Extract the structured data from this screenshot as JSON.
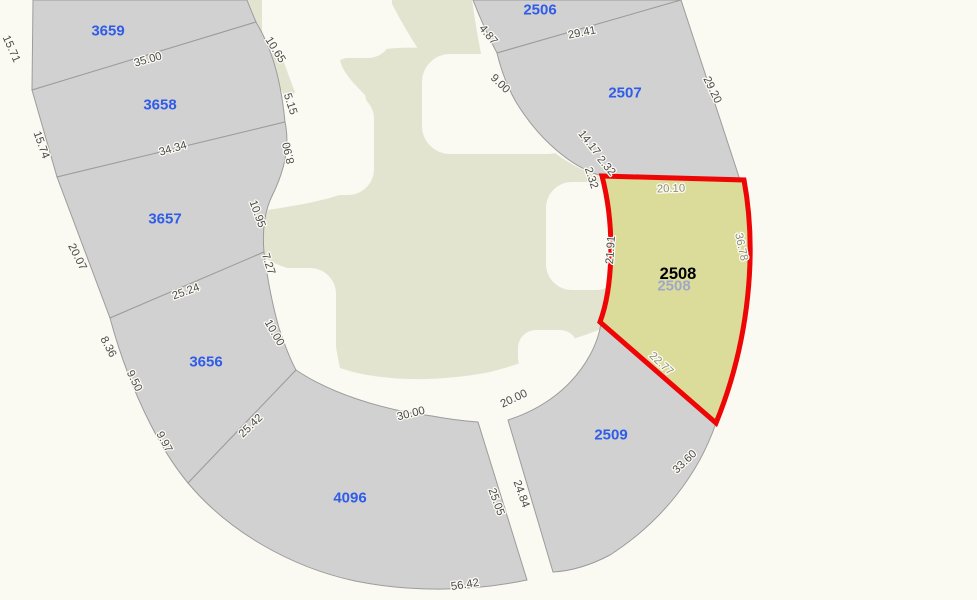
{
  "map": {
    "type": "cadastral-parcel-map",
    "colors": {
      "background": "#FAF9F2",
      "parcel_fill": "#D1D1D1",
      "parcel_line": "#9C9C9C",
      "green_area": "#E3E4D0",
      "highlight_fill": "#DCDC9A",
      "highlight_stroke": "#EE0505",
      "parcel_label_color": "#2F5CE8",
      "dim_label_color": "#4A4A4A",
      "dim_label_olive": "#8E8E74",
      "highlight_label_color": "#000000",
      "ghost_label_color": "#9FA8C8",
      "label_halo": "#FBFAF3"
    },
    "highlighted_parcel": {
      "id": "2508",
      "label": {
        "text": "2508",
        "x": 678,
        "y": 274
      },
      "ghost_label": {
        "text": "2508",
        "x": 674,
        "y": 286
      }
    },
    "parcel_labels": [
      {
        "id": "3659",
        "x": 108,
        "y": 31
      },
      {
        "id": "3658",
        "x": 160,
        "y": 105
      },
      {
        "id": "3657",
        "x": 165,
        "y": 219
      },
      {
        "id": "3656",
        "x": 206,
        "y": 362
      },
      {
        "id": "4096",
        "x": 350,
        "y": 498
      },
      {
        "id": "2506",
        "x": 540,
        "y": 10
      },
      {
        "id": "2507",
        "x": 625,
        "y": 93
      },
      {
        "id": "2509",
        "x": 611,
        "y": 435
      }
    ],
    "dimension_labels": [
      {
        "text": "15.71",
        "x": 11,
        "y": 49,
        "rot": 66
      },
      {
        "text": "35.00",
        "x": 148,
        "y": 60,
        "rot": -16
      },
      {
        "text": "15.74",
        "x": 41,
        "y": 145,
        "rot": 70
      },
      {
        "text": "34.34",
        "x": 173,
        "y": 149,
        "rot": -16
      },
      {
        "text": "20.07",
        "x": 77,
        "y": 257,
        "rot": 63
      },
      {
        "text": "25.24",
        "x": 186,
        "y": 292,
        "rot": -20
      },
      {
        "text": "8.36",
        "x": 108,
        "y": 347,
        "rot": 62
      },
      {
        "text": "9.50",
        "x": 134,
        "y": 381,
        "rot": 64
      },
      {
        "text": "9.97",
        "x": 164,
        "y": 442,
        "rot": 62
      },
      {
        "text": "25.42",
        "x": 251,
        "y": 426,
        "rot": -44
      },
      {
        "text": "10.65",
        "x": 275,
        "y": 50,
        "rot": 58
      },
      {
        "text": "5.15",
        "x": 290,
        "y": 104,
        "rot": 72
      },
      {
        "text": "8.90",
        "x": 289,
        "y": 153,
        "rot": -103
      },
      {
        "text": "10.95",
        "x": 257,
        "y": 214,
        "rot": 70
      },
      {
        "text": "7.27",
        "x": 268,
        "y": 264,
        "rot": 72
      },
      {
        "text": "10.00",
        "x": 274,
        "y": 333,
        "rot": 60
      },
      {
        "text": "30.00",
        "x": 411,
        "y": 414,
        "rot": -14
      },
      {
        "text": "20.00",
        "x": 514,
        "y": 399,
        "rot": -25
      },
      {
        "text": "25.05",
        "x": 496,
        "y": 502,
        "rot": 70
      },
      {
        "text": "24.84",
        "x": 521,
        "y": 494,
        "rot": 70
      },
      {
        "text": "56.42",
        "x": 465,
        "y": 585,
        "rot": -9
      },
      {
        "text": "33.60",
        "x": 685,
        "y": 462,
        "rot": -44
      },
      {
        "text": "4.87",
        "x": 488,
        "y": 35,
        "rot": 50
      },
      {
        "text": "29.41",
        "x": 582,
        "y": 33,
        "rot": -11
      },
      {
        "text": "9.00",
        "x": 500,
        "y": 84,
        "rot": 44
      },
      {
        "text": "29.20",
        "x": 712,
        "y": 90,
        "rot": 64
      },
      {
        "text": "14.17",
        "x": 589,
        "y": 143,
        "rot": 52
      },
      {
        "text": "2.32",
        "x": 606,
        "y": 166,
        "rot": 50
      },
      {
        "text": "2.32",
        "x": 591,
        "y": 178,
        "rot": 72
      },
      {
        "text": "21.91",
        "x": 611,
        "y": 250,
        "rot": -86
      },
      {
        "text": "20.10",
        "x": 671,
        "y": 189,
        "rot": -2,
        "tone": "olive"
      },
      {
        "text": "36.78",
        "x": 741,
        "y": 247,
        "rot": 78,
        "tone": "olive"
      },
      {
        "text": "22.77",
        "x": 661,
        "y": 364,
        "rot": 43,
        "tone": "olive"
      }
    ]
  }
}
